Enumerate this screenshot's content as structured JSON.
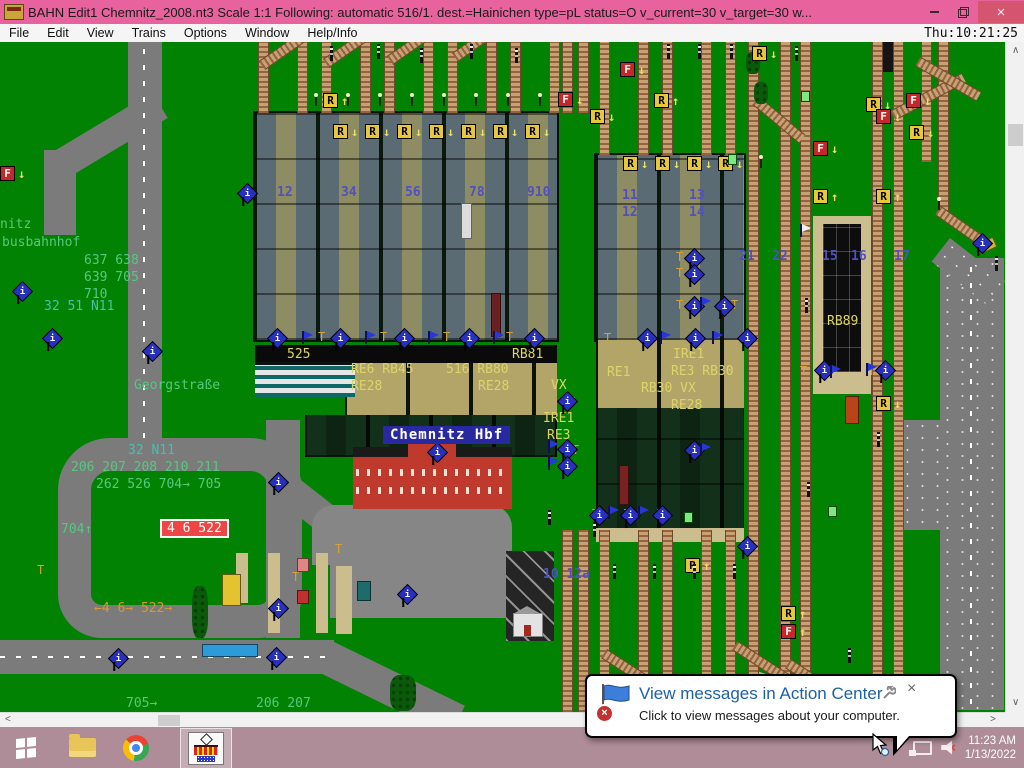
{
  "titlebar": {
    "title": "BAHN Edit1 Chemnitz_2008.nt3 Scale 1:1 Following: automatic 516/1.  dest.=Hainichen type=pL status=O  v_current=30 v_target=30 w...",
    "close": "×"
  },
  "menubar": {
    "items": [
      "File",
      "Edit",
      "View",
      "Trains",
      "Options",
      "Window",
      "Help/Info"
    ],
    "clock": "Thu:10:21:25"
  },
  "map": {
    "station_sign": "Chemnitz Hbf",
    "stop_box": {
      "text": "4 6 522",
      "x": 160,
      "y": 519
    },
    "labels": [
      {
        "t": "nitz",
        "x": 0,
        "y": 218,
        "c": "g"
      },
      {
        "t": "busbahnhof",
        "x": 2,
        "y": 236,
        "c": "g"
      },
      {
        "t": "637 638",
        "x": 84,
        "y": 254,
        "c": "g"
      },
      {
        "t": "639 705",
        "x": 84,
        "y": 271,
        "c": "g"
      },
      {
        "t": "710",
        "x": 84,
        "y": 288,
        "c": "g"
      },
      {
        "t": "32 51 N11",
        "x": 44,
        "y": 300,
        "c": "t"
      },
      {
        "t": "Georgstraße",
        "x": 134,
        "y": 379,
        "c": "g"
      },
      {
        "t": "32 N11",
        "x": 128,
        "y": 444,
        "c": "t"
      },
      {
        "t": "206 207 208 210 211",
        "x": 71,
        "y": 461,
        "c": "g"
      },
      {
        "t": "262 526 704→ 705",
        "x": 96,
        "y": 478,
        "c": "g"
      },
      {
        "t": "704↑",
        "x": 61,
        "y": 523,
        "c": "g"
      },
      {
        "t": "←4 6→ 522→",
        "x": 94,
        "y": 602,
        "c": "o"
      },
      {
        "t": "705→",
        "x": 126,
        "y": 697,
        "c": "g"
      },
      {
        "t": "206 207",
        "x": 256,
        "y": 697,
        "c": "g"
      },
      {
        "t": "525",
        "x": 287,
        "y": 348,
        "c": "y"
      },
      {
        "t": "RB81",
        "x": 512,
        "y": 348,
        "c": "y"
      },
      {
        "t": "RE6 RB45",
        "x": 351,
        "y": 363,
        "c": "y"
      },
      {
        "t": "RE28",
        "x": 351,
        "y": 380,
        "c": "y"
      },
      {
        "t": "516 RB80",
        "x": 446,
        "y": 363,
        "c": "y"
      },
      {
        "t": "RE28",
        "x": 478,
        "y": 380,
        "c": "y"
      },
      {
        "t": "VX",
        "x": 551,
        "y": 379,
        "c": "y"
      },
      {
        "t": "IRE1",
        "x": 543,
        "y": 412,
        "c": "y"
      },
      {
        "t": "RE3",
        "x": 547,
        "y": 429,
        "c": "y"
      },
      {
        "t": "RE1",
        "x": 607,
        "y": 366,
        "c": "y"
      },
      {
        "t": "IRE1",
        "x": 673,
        "y": 348,
        "c": "y"
      },
      {
        "t": "RE3 RB30",
        "x": 671,
        "y": 365,
        "c": "y"
      },
      {
        "t": "RB30 VX",
        "x": 641,
        "y": 382,
        "c": "y"
      },
      {
        "t": "RE28",
        "x": 671,
        "y": 399,
        "c": "y"
      },
      {
        "t": "RB89",
        "x": 827,
        "y": 315,
        "c": "y"
      },
      {
        "t": "12",
        "x": 277,
        "y": 186,
        "c": "b"
      },
      {
        "t": "34",
        "x": 341,
        "y": 186,
        "c": "b"
      },
      {
        "t": "56",
        "x": 405,
        "y": 186,
        "c": "b"
      },
      {
        "t": "78",
        "x": 469,
        "y": 186,
        "c": "b"
      },
      {
        "t": "910",
        "x": 527,
        "y": 186,
        "c": "b"
      },
      {
        "t": "11",
        "x": 622,
        "y": 189,
        "c": "b"
      },
      {
        "t": "12",
        "x": 622,
        "y": 206,
        "c": "b"
      },
      {
        "t": "13",
        "x": 689,
        "y": 189,
        "c": "b"
      },
      {
        "t": "14",
        "x": 689,
        "y": 206,
        "c": "b"
      },
      {
        "t": "21",
        "x": 739,
        "y": 250,
        "c": "b"
      },
      {
        "t": "22",
        "x": 772,
        "y": 250,
        "c": "b"
      },
      {
        "t": "15",
        "x": 822,
        "y": 250,
        "c": "b"
      },
      {
        "t": "16",
        "x": 851,
        "y": 250,
        "c": "b"
      },
      {
        "t": "17",
        "x": 894,
        "y": 250,
        "c": "b"
      },
      {
        "t": "10 12a",
        "x": 543,
        "y": 568,
        "c": "b"
      },
      {
        "t": "T",
        "x": 318,
        "y": 330,
        "c": "o2"
      },
      {
        "t": "T",
        "x": 380,
        "y": 330,
        "c": "o2"
      },
      {
        "t": "T",
        "x": 443,
        "y": 330,
        "c": "o2"
      },
      {
        "t": "T",
        "x": 506,
        "y": 330,
        "c": "o2"
      },
      {
        "t": "T",
        "x": 604,
        "y": 331,
        "c": "o2"
      },
      {
        "t": "T",
        "x": 676,
        "y": 250,
        "c": "o2"
      },
      {
        "t": "T",
        "x": 676,
        "y": 266,
        "c": "o2"
      },
      {
        "t": "T",
        "x": 676,
        "y": 298,
        "c": "o2"
      },
      {
        "t": "T",
        "x": 731,
        "y": 298,
        "c": "o2"
      },
      {
        "t": "T",
        "x": 568,
        "y": 395,
        "c": "o2"
      },
      {
        "t": "T",
        "x": 572,
        "y": 443,
        "c": "o2"
      },
      {
        "t": "T",
        "x": 800,
        "y": 364,
        "c": "o2"
      },
      {
        "t": "T",
        "x": 868,
        "y": 364,
        "c": "o2"
      },
      {
        "t": "T",
        "x": 592,
        "y": 507,
        "c": "o2"
      },
      {
        "t": "T",
        "x": 624,
        "y": 507,
        "c": "o2"
      },
      {
        "t": "T",
        "x": 657,
        "y": 507,
        "c": "o2"
      },
      {
        "t": "T",
        "x": 292,
        "y": 570,
        "c": "o2"
      },
      {
        "t": "T",
        "x": 335,
        "y": 542,
        "c": "o2"
      },
      {
        "t": "T",
        "x": 37,
        "y": 563,
        "c": "o2"
      }
    ],
    "signs": [
      {
        "t": "R",
        "a": "↓",
        "x": 333,
        "y": 124
      },
      {
        "t": "R",
        "a": "↓",
        "x": 365,
        "y": 124
      },
      {
        "t": "R",
        "a": "↓",
        "x": 397,
        "y": 124
      },
      {
        "t": "R",
        "a": "↓",
        "x": 429,
        "y": 124
      },
      {
        "t": "R",
        "a": "↓",
        "x": 461,
        "y": 124
      },
      {
        "t": "R",
        "a": "↓",
        "x": 493,
        "y": 124
      },
      {
        "t": "R",
        "a": "↓",
        "x": 525,
        "y": 124
      },
      {
        "t": "R",
        "a": "↓",
        "x": 623,
        "y": 156
      },
      {
        "t": "R",
        "a": "↓",
        "x": 655,
        "y": 156
      },
      {
        "t": "R",
        "a": "↓",
        "x": 687,
        "y": 156
      },
      {
        "t": "R",
        "a": "↓",
        "x": 718,
        "y": 156
      },
      {
        "t": "R",
        "a": "↑",
        "x": 323,
        "y": 93
      },
      {
        "t": "R",
        "a": "↓",
        "x": 752,
        "y": 46
      },
      {
        "t": "R",
        "a": "↑",
        "x": 654,
        "y": 93
      },
      {
        "t": "R",
        "a": "↓",
        "x": 590,
        "y": 109
      },
      {
        "t": "R",
        "a": "↓",
        "x": 866,
        "y": 97
      },
      {
        "t": "R",
        "a": "↓",
        "x": 909,
        "y": 125
      },
      {
        "t": "R",
        "a": "↑",
        "x": 813,
        "y": 189
      },
      {
        "t": "R",
        "a": "↑",
        "x": 876,
        "y": 189
      },
      {
        "t": "R",
        "a": "↓",
        "x": 876,
        "y": 396
      },
      {
        "t": "R",
        "a": "↑",
        "x": 781,
        "y": 606
      },
      {
        "t": "F",
        "a": "↑",
        "x": 781,
        "y": 624
      },
      {
        "t": "R",
        "a": "↑",
        "x": 685,
        "y": 558
      },
      {
        "t": "F",
        "a": "↓",
        "x": 620,
        "y": 62
      },
      {
        "t": "F",
        "a": "↓",
        "x": 558,
        "y": 92
      },
      {
        "t": "F",
        "a": "↓",
        "x": 813,
        "y": 141
      },
      {
        "t": "F",
        "a": "↓",
        "x": 876,
        "y": 109
      },
      {
        "t": "F",
        "a": "↓",
        "x": 906,
        "y": 93
      },
      {
        "t": "F",
        "a": "↓",
        "x": 0,
        "y": 166
      }
    ],
    "icons": [
      {
        "x": 15,
        "y": 284,
        "k": "i"
      },
      {
        "x": 45,
        "y": 331,
        "k": "i"
      },
      {
        "x": 240,
        "y": 186,
        "k": "i"
      },
      {
        "x": 145,
        "y": 344,
        "k": "i"
      },
      {
        "x": 271,
        "y": 475,
        "k": "i"
      },
      {
        "x": 111,
        "y": 651,
        "k": "i"
      },
      {
        "x": 271,
        "y": 601,
        "k": "i"
      },
      {
        "x": 269,
        "y": 650,
        "k": "i"
      },
      {
        "x": 400,
        "y": 587,
        "k": "i"
      },
      {
        "x": 975,
        "y": 236,
        "k": "i"
      },
      {
        "x": 270,
        "y": 331,
        "k": "i"
      },
      {
        "x": 333,
        "y": 331,
        "k": "i"
      },
      {
        "x": 397,
        "y": 331,
        "k": "i"
      },
      {
        "x": 462,
        "y": 331,
        "k": "i"
      },
      {
        "x": 527,
        "y": 331,
        "k": "i"
      },
      {
        "x": 640,
        "y": 331,
        "k": "i"
      },
      {
        "x": 688,
        "y": 331,
        "k": "i"
      },
      {
        "x": 740,
        "y": 331,
        "k": "i"
      },
      {
        "x": 560,
        "y": 394,
        "k": "i"
      },
      {
        "x": 560,
        "y": 442,
        "k": "i"
      },
      {
        "x": 560,
        "y": 459,
        "k": "i"
      },
      {
        "x": 687,
        "y": 251,
        "k": "i"
      },
      {
        "x": 687,
        "y": 267,
        "k": "i"
      },
      {
        "x": 687,
        "y": 299,
        "k": "i"
      },
      {
        "x": 717,
        "y": 299,
        "k": "i"
      },
      {
        "x": 817,
        "y": 363,
        "k": "i"
      },
      {
        "x": 878,
        "y": 363,
        "k": "i"
      },
      {
        "x": 592,
        "y": 508,
        "k": "i"
      },
      {
        "x": 623,
        "y": 508,
        "k": "i"
      },
      {
        "x": 655,
        "y": 508,
        "k": "i"
      },
      {
        "x": 687,
        "y": 443,
        "k": "i"
      },
      {
        "x": 740,
        "y": 539,
        "k": "i"
      },
      {
        "x": 430,
        "y": 445,
        "k": "i"
      },
      {
        "x": 302,
        "y": 331,
        "k": "f"
      },
      {
        "x": 365,
        "y": 331,
        "k": "f"
      },
      {
        "x": 428,
        "y": 331,
        "k": "f"
      },
      {
        "x": 493,
        "y": 331,
        "k": "f"
      },
      {
        "x": 660,
        "y": 331,
        "k": "f"
      },
      {
        "x": 712,
        "y": 331,
        "k": "f"
      },
      {
        "x": 830,
        "y": 365,
        "k": "f"
      },
      {
        "x": 866,
        "y": 363,
        "k": "f"
      },
      {
        "x": 608,
        "y": 506,
        "k": "f"
      },
      {
        "x": 638,
        "y": 506,
        "k": "f"
      },
      {
        "x": 700,
        "y": 443,
        "k": "f"
      },
      {
        "x": 548,
        "y": 440,
        "k": "f"
      },
      {
        "x": 548,
        "y": 457,
        "k": "f"
      },
      {
        "x": 700,
        "y": 297,
        "k": "f"
      },
      {
        "x": 800,
        "y": 224,
        "k": "w"
      }
    ],
    "signals": [
      {
        "x": 330,
        "y": 46,
        "k": "s"
      },
      {
        "x": 377,
        "y": 44,
        "k": "s"
      },
      {
        "x": 420,
        "y": 48,
        "k": "s"
      },
      {
        "x": 470,
        "y": 44,
        "k": "s"
      },
      {
        "x": 515,
        "y": 48,
        "k": "s"
      },
      {
        "x": 667,
        "y": 44,
        "k": "s"
      },
      {
        "x": 698,
        "y": 44,
        "k": "s"
      },
      {
        "x": 730,
        "y": 44,
        "k": "s"
      },
      {
        "x": 795,
        "y": 46,
        "k": "s"
      },
      {
        "x": 805,
        "y": 298,
        "k": "s"
      },
      {
        "x": 995,
        "y": 256,
        "k": "s"
      },
      {
        "x": 807,
        "y": 482,
        "k": "s"
      },
      {
        "x": 877,
        "y": 432,
        "k": "s"
      },
      {
        "x": 548,
        "y": 510,
        "k": "s"
      },
      {
        "x": 593,
        "y": 522,
        "k": "s"
      },
      {
        "x": 613,
        "y": 564,
        "k": "s"
      },
      {
        "x": 653,
        "y": 564,
        "k": "s"
      },
      {
        "x": 693,
        "y": 564,
        "k": "s"
      },
      {
        "x": 733,
        "y": 564,
        "k": "s"
      },
      {
        "x": 848,
        "y": 648,
        "k": "s"
      },
      {
        "x": 315,
        "y": 96,
        "k": "l"
      },
      {
        "x": 347,
        "y": 96,
        "k": "l"
      },
      {
        "x": 379,
        "y": 96,
        "k": "l"
      },
      {
        "x": 411,
        "y": 96,
        "k": "l"
      },
      {
        "x": 443,
        "y": 96,
        "k": "l"
      },
      {
        "x": 475,
        "y": 96,
        "k": "l"
      },
      {
        "x": 507,
        "y": 96,
        "k": "l"
      },
      {
        "x": 539,
        "y": 96,
        "k": "l"
      },
      {
        "x": 760,
        "y": 158,
        "k": "l"
      },
      {
        "x": 938,
        "y": 200,
        "k": "l"
      },
      {
        "x": 801,
        "y": 91,
        "k": "g"
      },
      {
        "x": 684,
        "y": 512,
        "k": "g"
      },
      {
        "x": 828,
        "y": 506,
        "k": "g"
      },
      {
        "x": 728,
        "y": 154,
        "k": "g"
      }
    ],
    "tracks": {
      "v": [
        [
          258,
          42,
          71
        ],
        [
          297,
          42,
          71
        ],
        [
          321,
          42,
          71
        ],
        [
          360,
          42,
          71
        ],
        [
          384,
          42,
          71
        ],
        [
          423,
          42,
          71
        ],
        [
          447,
          42,
          71
        ],
        [
          486,
          42,
          71
        ],
        [
          510,
          42,
          71
        ],
        [
          549,
          42,
          71
        ],
        [
          562,
          42,
          71
        ],
        [
          578,
          42,
          71
        ],
        [
          562,
          530,
          182
        ],
        [
          578,
          530,
          182
        ],
        [
          599,
          42,
          113
        ],
        [
          638,
          42,
          113
        ],
        [
          662,
          42,
          113
        ],
        [
          701,
          42,
          113
        ],
        [
          725,
          42,
          113
        ],
        [
          599,
          530,
          182
        ],
        [
          638,
          530,
          182
        ],
        [
          662,
          530,
          182
        ],
        [
          701,
          530,
          182
        ],
        [
          725,
          530,
          182
        ],
        [
          748,
          42,
          670
        ],
        [
          780,
          42,
          670
        ],
        [
          800,
          42,
          670
        ],
        [
          872,
          42,
          670
        ],
        [
          893,
          42,
          670
        ],
        [
          921,
          42,
          120
        ],
        [
          938,
          42,
          175
        ]
      ],
      "d": [
        [
          893,
          110,
          80,
          -28
        ],
        [
          756,
          95,
          60,
          40
        ],
        [
          918,
          56,
          70,
          30
        ],
        [
          938,
          205,
          60,
          35
        ],
        [
          735,
          640,
          130,
          33
        ],
        [
          788,
          658,
          120,
          33
        ],
        [
          604,
          648,
          110,
          33
        ],
        [
          262,
          60,
          70,
          -35
        ],
        [
          326,
          58,
          70,
          -35
        ],
        [
          390,
          55,
          70,
          -35
        ],
        [
          455,
          52,
          70,
          -35
        ]
      ]
    },
    "vehicles": [
      {
        "x": 461,
        "y": 203,
        "w": 9,
        "h": 34,
        "c": "#dcdcdc"
      },
      {
        "x": 491,
        "y": 293,
        "w": 8,
        "h": 42,
        "c": "#6b1f1f"
      },
      {
        "x": 619,
        "y": 465,
        "w": 8,
        "h": 38,
        "c": "#7a2222"
      },
      {
        "x": 222,
        "y": 574,
        "w": 17,
        "h": 30,
        "c": "#e3c32f"
      },
      {
        "x": 202,
        "y": 644,
        "w": 54,
        "h": 11,
        "c": "#2f9ad8"
      },
      {
        "x": 845,
        "y": 396,
        "w": 12,
        "h": 26,
        "c": "#b84418"
      },
      {
        "x": 978,
        "y": 240,
        "w": 16,
        "h": 9,
        "c": "#c8b82a",
        "r": -25
      },
      {
        "x": 297,
        "y": 558,
        "w": 10,
        "h": 12,
        "c": "#e08484"
      },
      {
        "x": 297,
        "y": 590,
        "w": 10,
        "h": 12,
        "c": "#c23030"
      },
      {
        "x": 357,
        "y": 581,
        "w": 12,
        "h": 18,
        "c": "#1d6b6b"
      }
    ],
    "trees": [
      [
        390,
        675,
        26,
        36
      ],
      [
        746,
        52,
        14,
        22
      ],
      [
        754,
        82,
        14,
        22
      ],
      [
        192,
        586,
        16,
        52
      ]
    ]
  },
  "scroll": {
    "up": "∧",
    "down": "∨",
    "left": "<",
    "right": ">"
  },
  "notification": {
    "title": "View messages in Action Center",
    "body": "Click to view messages about your computer.",
    "close": "×"
  },
  "taskbar": {
    "time": "11:23 AM",
    "date": "1/13/2022"
  }
}
